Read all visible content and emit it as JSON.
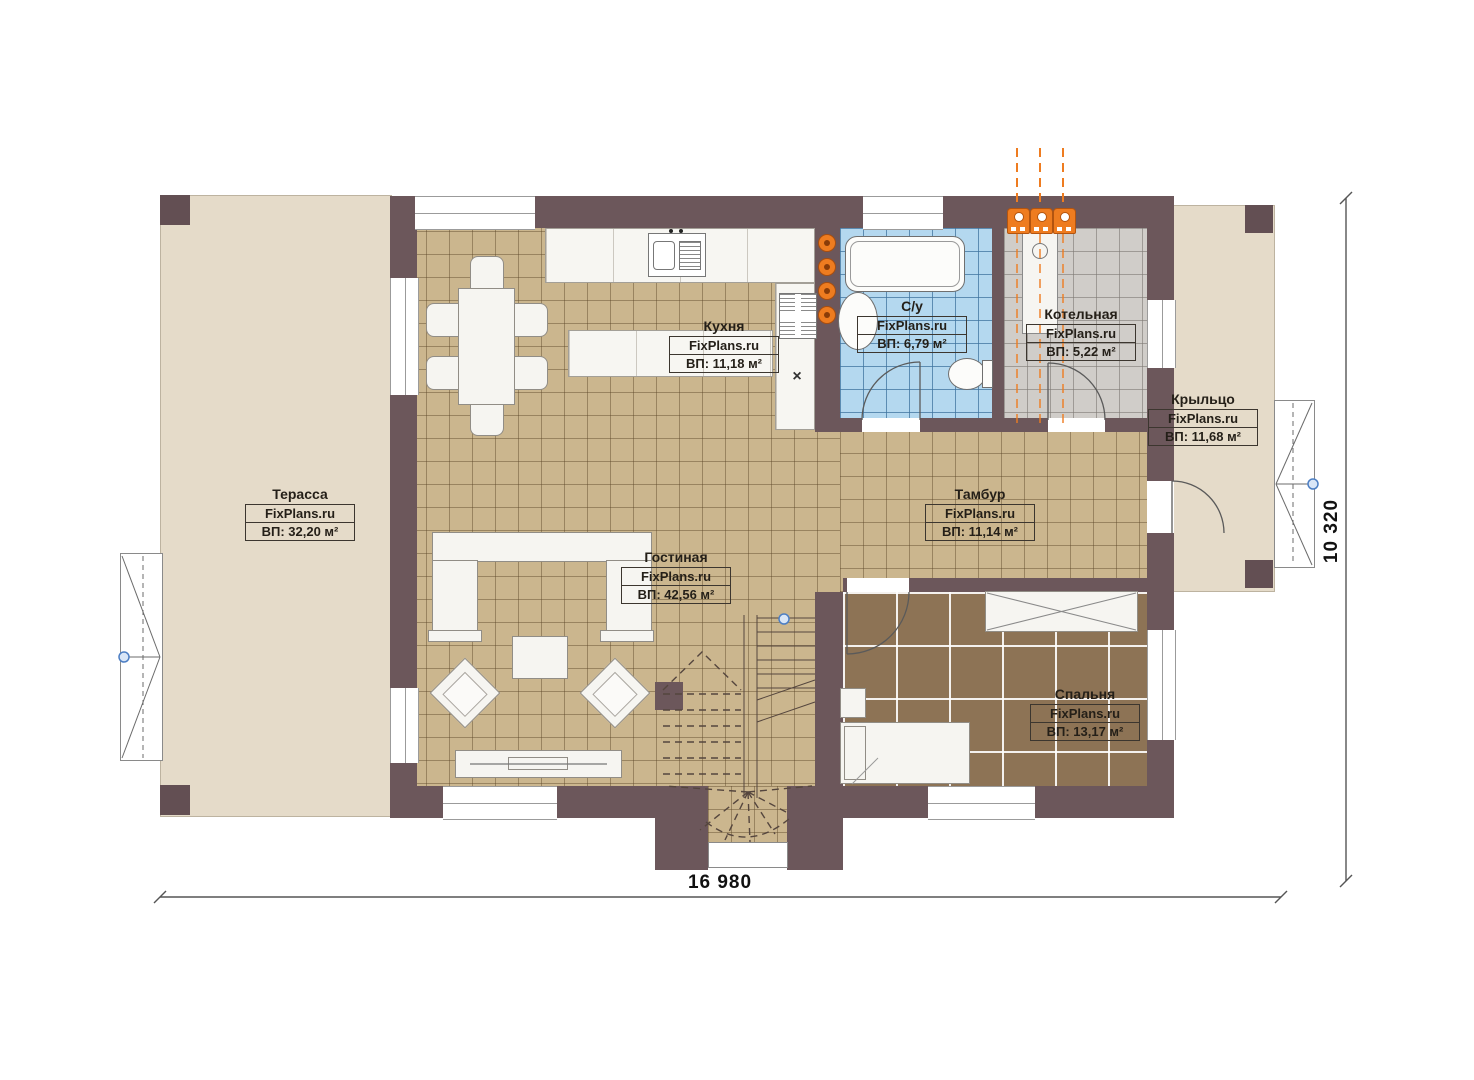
{
  "plan": {
    "brand": "FixPlans.ru",
    "dimensions": {
      "width_label": "16 980",
      "height_label": "10 320"
    },
    "rooms": [
      {
        "name": "Терасса",
        "brand": "FixPlans.ru",
        "area": "ВП: 32,20 м²"
      },
      {
        "name": "Кухня",
        "brand": "FixPlans.ru",
        "area": "ВП: 11,18 м²"
      },
      {
        "name": "С/у",
        "brand": "FixPlans.ru",
        "area": "ВП: 6,79 м²"
      },
      {
        "name": "Котельная",
        "brand": "FixPlans.ru",
        "area": "ВП: 5,22 м²"
      },
      {
        "name": "Крыльцо",
        "brand": "FixPlans.ru",
        "area": "ВП: 11,68 м²"
      },
      {
        "name": "Тамбур",
        "brand": "FixPlans.ru",
        "area": "ВП: 11,14 м²"
      },
      {
        "name": "Гостиная",
        "brand": "FixPlans.ru",
        "area": "ВП: 42,56 м²"
      },
      {
        "name": "Спальня",
        "brand": "FixPlans.ru",
        "area": "ВП: 13,17 м²"
      }
    ],
    "symbols": {
      "stove_x": "×"
    },
    "colors": {
      "wall": "#6c575b",
      "terrace_floor": "#e5dbc9",
      "wood_tile_floor": "#cbb68e",
      "bath_tile_floor": "#b4d8ef",
      "boiler_tile_floor": "#d0cdc9",
      "bedroom_floor": "#8d7355",
      "heating_accent": "#ee7c20",
      "level_marker": "#4d7fc4"
    },
    "icons": {
      "heating_unit": "orange-box-with-dot",
      "heating_valve": "orange-circle",
      "level_marker": "blue-dot"
    }
  }
}
